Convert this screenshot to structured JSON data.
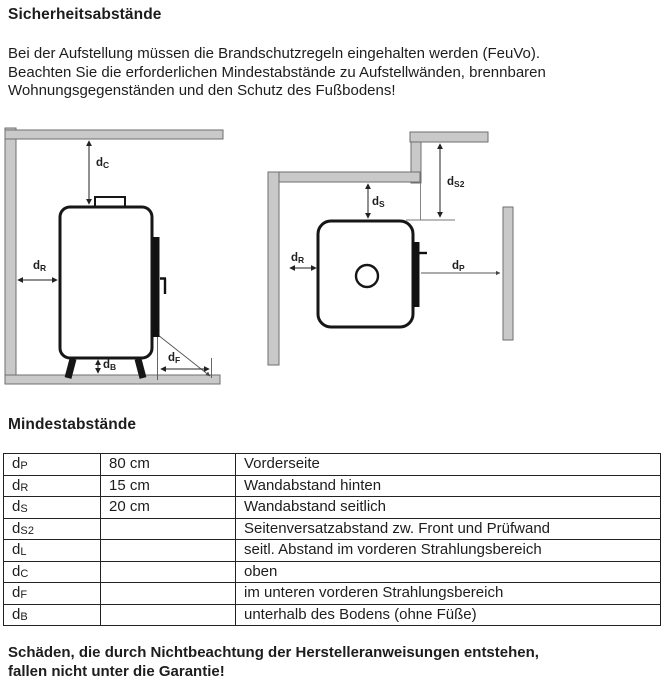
{
  "page": {
    "title": "Sicherheitsabstände",
    "intro_lines": [
      "Bei der Aufstellung müssen die Brandschutzregeln eingehalten werden (FeuVo).",
      "Beachten Sie die erforderlichen Mindestabstände zu Aufstellwänden, brennbaren",
      "Wohnungsgegenständen und den Schutz des Fußbodens!"
    ],
    "table_title": "Mindestabstände",
    "warning_lines": [
      "Schäden, die durch Nichtbeachtung der Herstelleranweisungen entstehen,",
      "fallen nicht unter die Garantie!"
    ]
  },
  "figures": {
    "colors": {
      "wall_fill": "#c9c9c9",
      "wall_border": "#6e6e6e",
      "outline": "#161616",
      "arrow": "#222222"
    },
    "front_view": {
      "labels": {
        "dc": {
          "base": "d",
          "sub": "C"
        },
        "dr": {
          "base": "d",
          "sub": "R"
        },
        "db": {
          "base": "d",
          "sub": "B"
        },
        "df": {
          "base": "d",
          "sub": "F"
        }
      }
    },
    "top_view": {
      "labels": {
        "ds": {
          "base": "d",
          "sub": "S"
        },
        "ds2": {
          "base": "d",
          "sub": "S2"
        },
        "dr": {
          "base": "d",
          "sub": "R"
        },
        "dp": {
          "base": "d",
          "sub": "P"
        }
      }
    }
  },
  "table": {
    "rows": [
      {
        "symbol": {
          "base": "d",
          "sub": "P"
        },
        "value": "80 cm",
        "description": "Vorderseite"
      },
      {
        "symbol": {
          "base": "d",
          "sub": "R"
        },
        "value": "15 cm",
        "description": "Wandabstand hinten"
      },
      {
        "symbol": {
          "base": "d",
          "sub": "S"
        },
        "value": "20 cm",
        "description": "Wandabstand seitlich"
      },
      {
        "symbol": {
          "base": "d",
          "sub": "S2"
        },
        "value": "",
        "description": "Seitenversatzabstand zw. Front und Prüfwand"
      },
      {
        "symbol": {
          "base": "d",
          "sub": "L"
        },
        "value": "",
        "description": "seitl. Abstand im vorderen Strahlungsbereich"
      },
      {
        "symbol": {
          "base": "d",
          "sub": "C"
        },
        "value": "",
        "description": "oben"
      },
      {
        "symbol": {
          "base": "d",
          "sub": "F"
        },
        "value": "",
        "description": "im unteren vorderen Strahlungsbereich"
      },
      {
        "symbol": {
          "base": "d",
          "sub": "B"
        },
        "value": "",
        "description": "unterhalb des Bodens (ohne Füße)"
      }
    ]
  }
}
